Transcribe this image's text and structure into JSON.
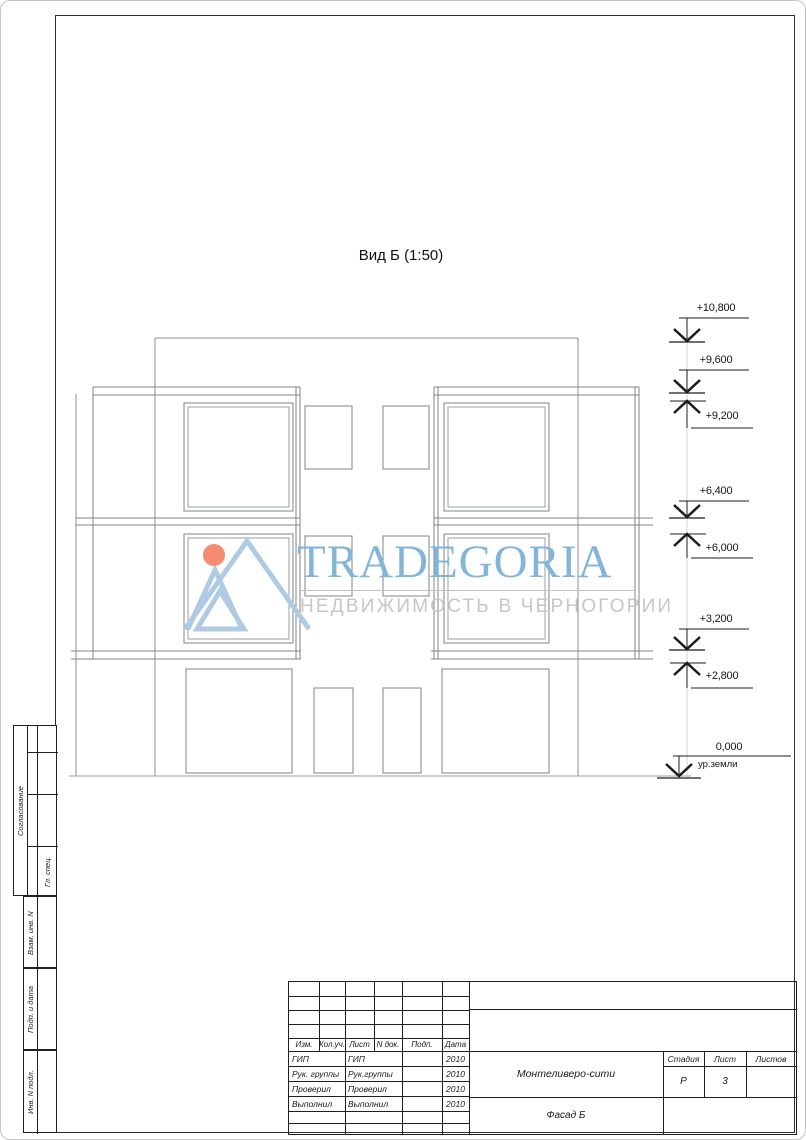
{
  "page": {
    "view_title": "Вид Б (1:50)"
  },
  "watermark": {
    "brand": "TRADEGORIA",
    "tagline": "НЕДВИЖИМОСТЬ В ЧЕРНОГОРИИ",
    "brand_color": "#83b5da",
    "tagline_color": "#c4c7ca",
    "logo_dot_color": "#f58b70",
    "logo_line_color": "#aecbe3"
  },
  "elevations": [
    {
      "value": "+10,800"
    },
    {
      "value": "+9,600"
    },
    {
      "value": "+9,200"
    },
    {
      "value": "+6,400"
    },
    {
      "value": "+6,000"
    },
    {
      "value": "+3,200"
    },
    {
      "value": "+2,800"
    },
    {
      "value": "0,000",
      "note": "ур.земли"
    }
  ],
  "side_stamp": {
    "approval": "Согласование",
    "chief": "Гл. спец.",
    "box1": "Взам. инв. N",
    "box2": "Подп. и дата",
    "box3": "Инв. N подл."
  },
  "title_block": {
    "header": [
      "Изм.",
      "Кол.уч.",
      "Лист",
      "N док.",
      "Подп.",
      "Дата"
    ],
    "rows": [
      {
        "role": "ГИП",
        "name": "ГИП",
        "date": "2010"
      },
      {
        "role": "Рук. группы",
        "name": "Рук.группы",
        "date": "2010"
      },
      {
        "role": "Проверил",
        "name": "Проверил",
        "date": "2010"
      },
      {
        "role": "Выполнил",
        "name": "Выполнил",
        "date": "2010"
      }
    ],
    "project": "Монтеливеро-сити",
    "sheet_title": "Фасад Б",
    "stage_label": "Стадия",
    "sheet_label": "Лист",
    "sheets_label": "Листов",
    "stage": "Р",
    "sheet": "3",
    "sheets": ""
  }
}
